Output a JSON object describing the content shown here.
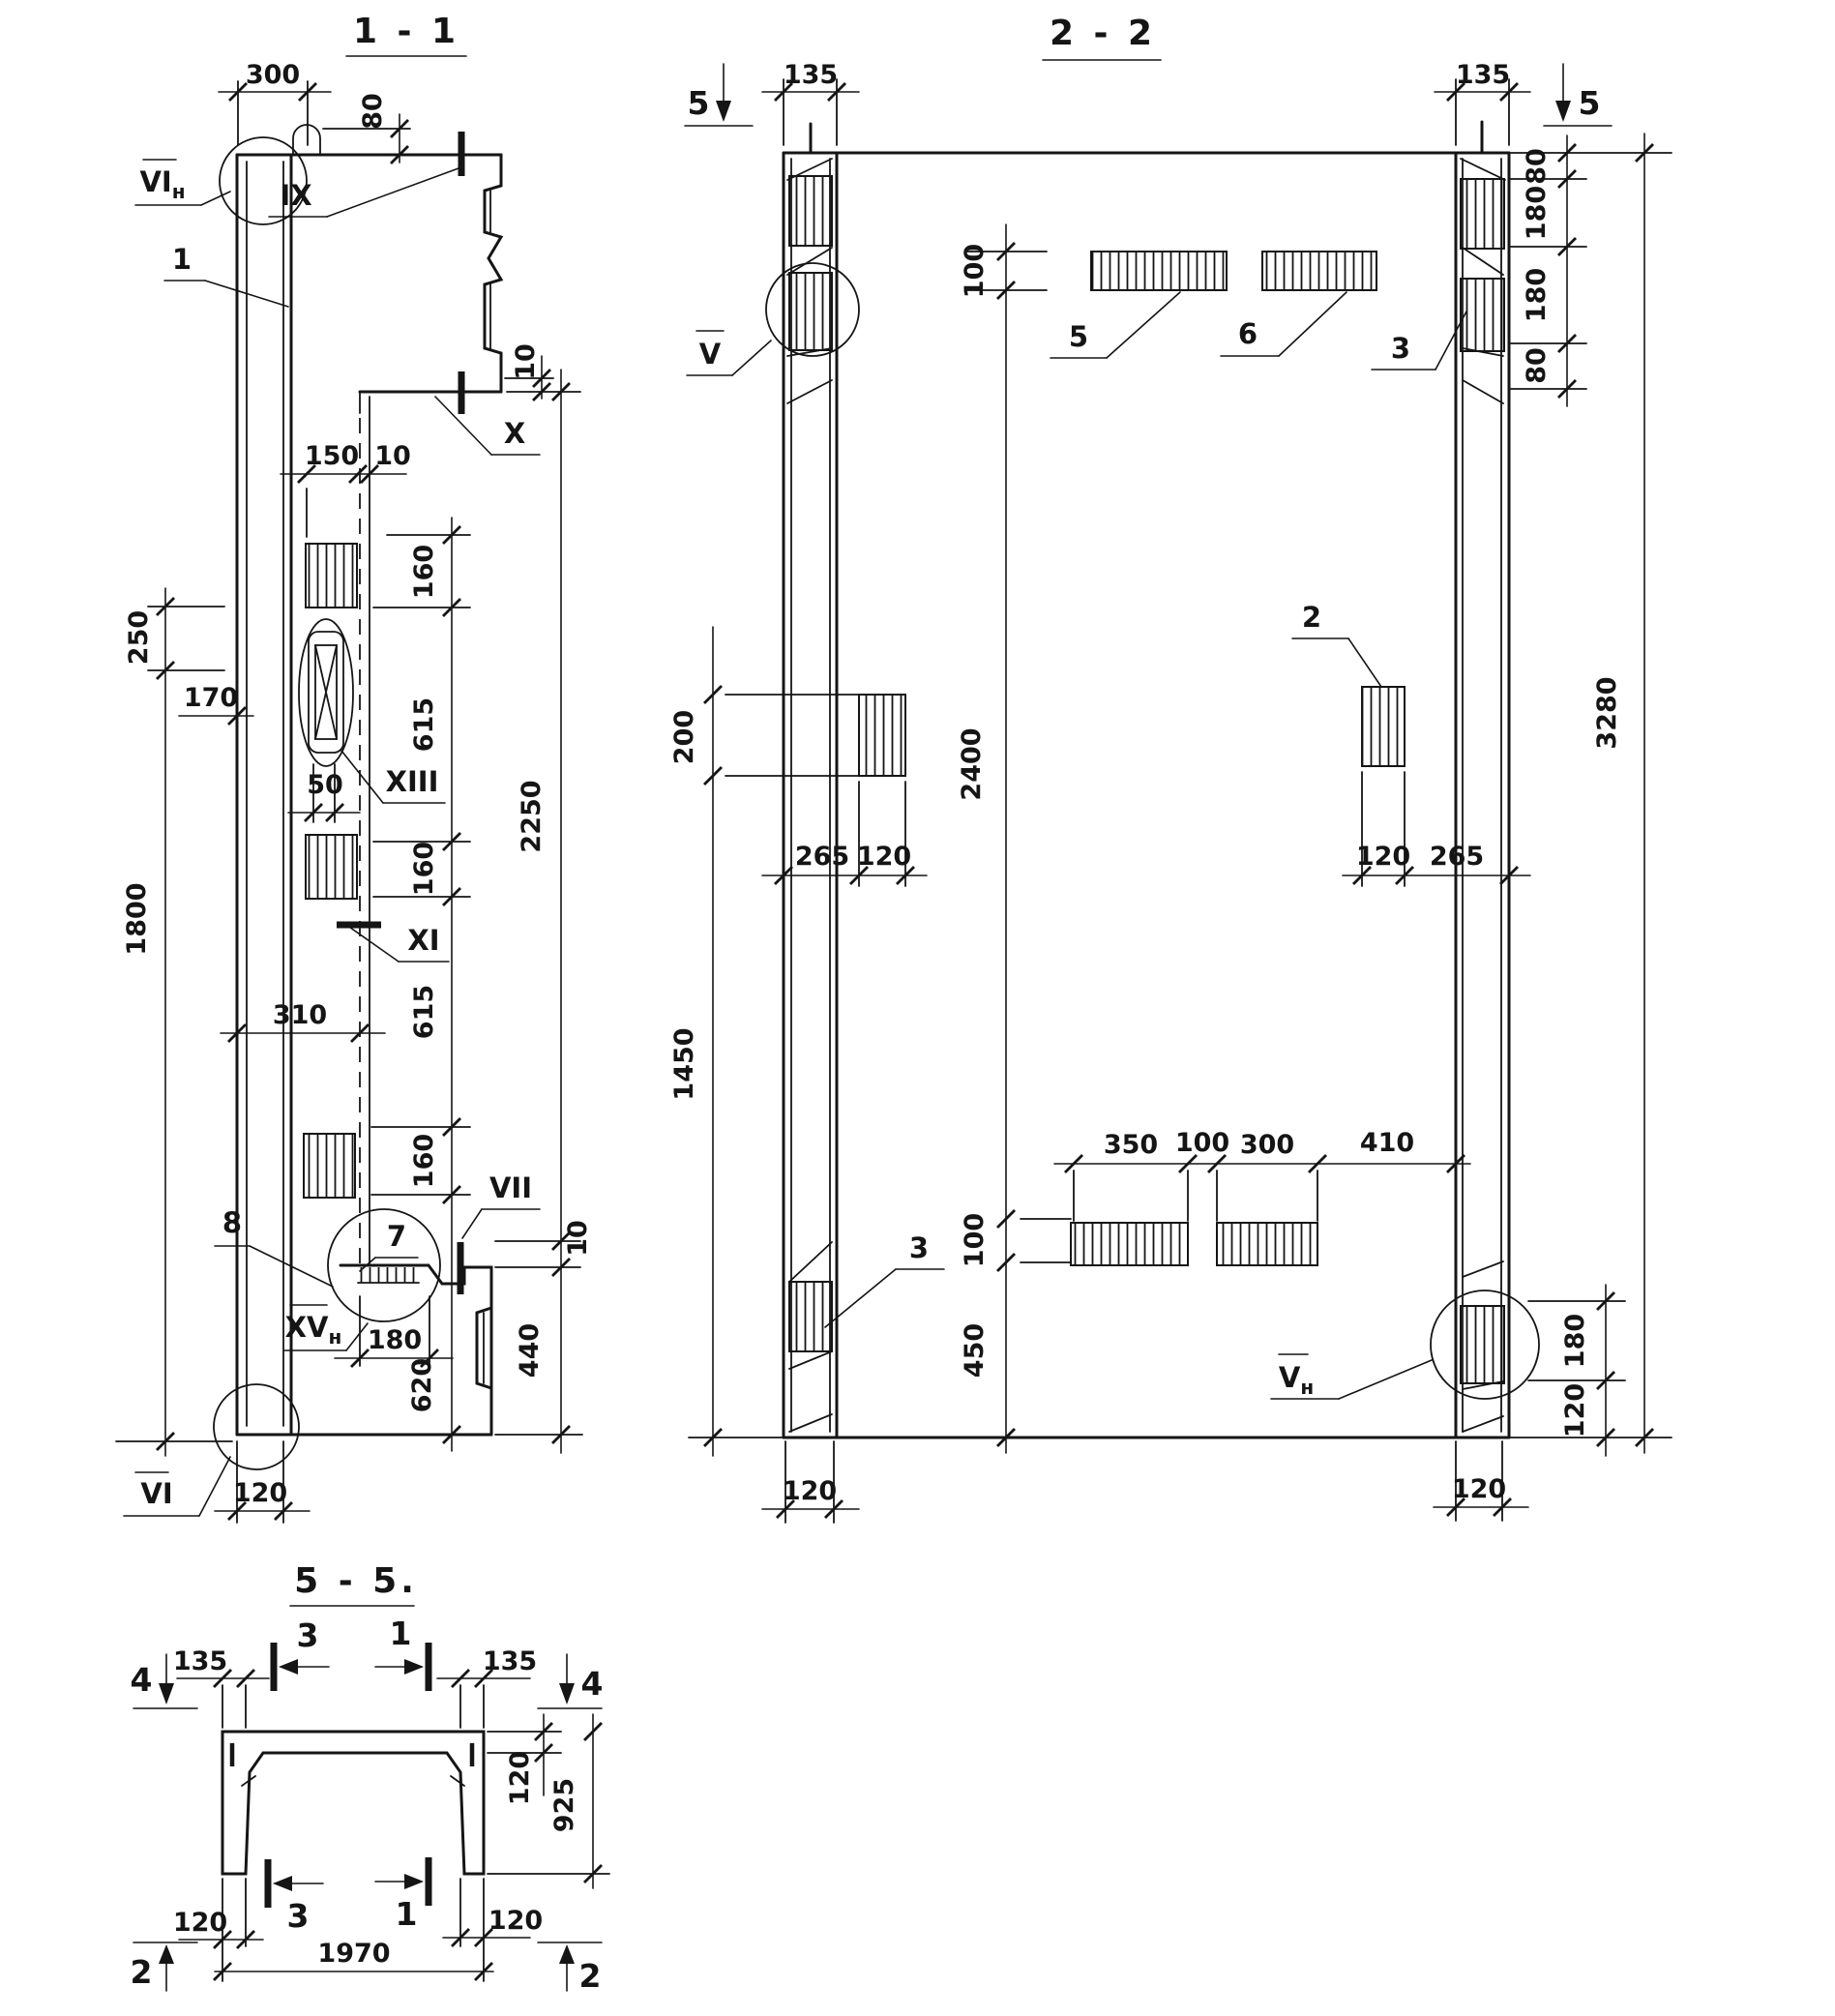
{
  "s11": {
    "title": "1 - 1",
    "dims": {
      "w300": "300",
      "h80": "80",
      "g10_top": "10",
      "w150": "150",
      "g10_mid": "10",
      "c160a": "160",
      "c615a": "615",
      "c160b": "160",
      "c615b": "615",
      "c160c": "160",
      "c620": "620",
      "v2250": "2250",
      "g10_vii": "10",
      "v440": "440",
      "v250": "250",
      "w170": "170",
      "v1800": "1800",
      "w310": "310",
      "w50": "50",
      "w180": "180",
      "w120": "120"
    },
    "callouts": {
      "vi_n_base": "VI",
      "vi_n_sub": "н",
      "ix": "IX",
      "x": "X",
      "xiii": "XIII",
      "xi": "XI",
      "vii": "VII",
      "xv_n_base": "XV",
      "xv_n_sub": "н",
      "vi": "VI",
      "p1": "1",
      "p7": "7",
      "p8": "8"
    }
  },
  "s22": {
    "title": "2 - 2",
    "markers": {
      "m5l": "5",
      "m5r": "5"
    },
    "dims": {
      "w135l": "135",
      "w135r": "135",
      "r80a": "80",
      "r180a": "180",
      "r180b": "180",
      "r80b": "80",
      "i100t": "100",
      "i2400": "2400",
      "i100b": "100",
      "i450": "450",
      "l200": "200",
      "l1450": "1450",
      "lm265": "265",
      "lm120": "120",
      "rm120": "120",
      "rm265": "265",
      "b350": "350",
      "b100": "100",
      "b300": "300",
      "b410": "410",
      "rb180": "180",
      "rb120": "120",
      "bl120": "120",
      "br120": "120",
      "h3280": "3280"
    },
    "callouts": {
      "v_base": "V",
      "p5": "5",
      "p6": "6",
      "p3t": "3",
      "p2": "2",
      "p3b": "3",
      "vn_base": "V",
      "vn_sub": "н"
    }
  },
  "s55": {
    "title": "5 - 5.",
    "markers": {
      "m3t": "3",
      "m1t": "1",
      "m4l": "4",
      "m4r": "4",
      "m3b": "3",
      "m1b": "1",
      "m2l": "2",
      "m2r": "2"
    },
    "dims": {
      "w135l": "135",
      "w135r": "135",
      "t120": "120",
      "h925": "925",
      "b120l": "120",
      "b120r": "120",
      "w1970": "1970"
    }
  }
}
